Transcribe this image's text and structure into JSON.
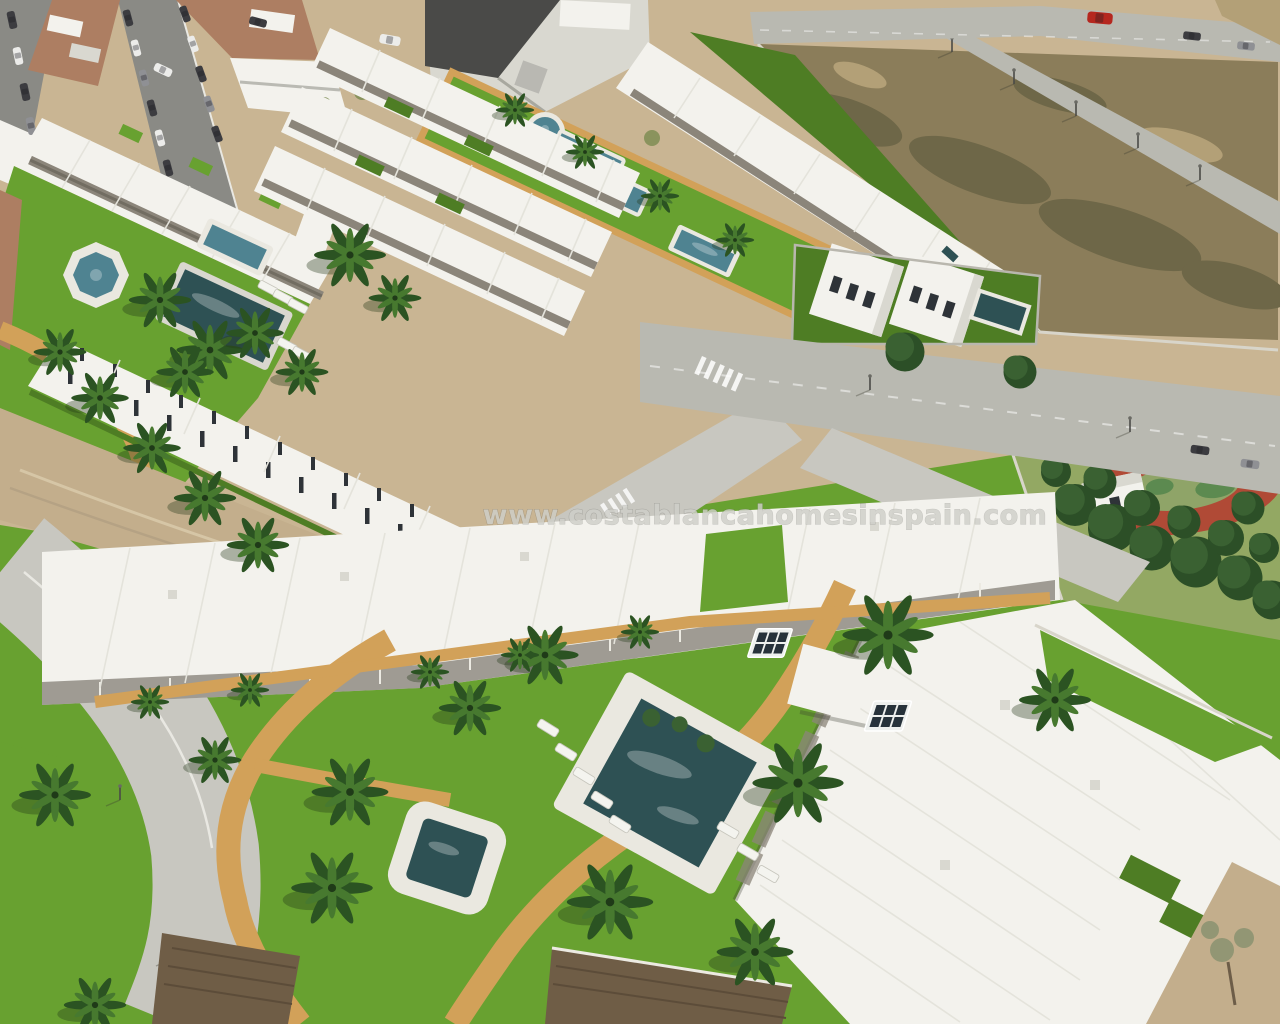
{
  "watermark": {
    "text": "www.costablancahomesinspain.com"
  },
  "colors": {
    "sand": "#c9b593",
    "dirt": "#c3ae8c",
    "field": "#8b7d5a",
    "field_dark": "#6e6748",
    "field_light": "#b3a077",
    "road": "#b9b9b1",
    "road_light": "#c8c7c0",
    "asphalt": "#8a8a85",
    "grass": "#68a130",
    "grass_dark": "#4e7d24",
    "park_grass": "#93a863",
    "tree": "#3a6132",
    "tree_dark": "#2c4f27",
    "tree_olive": "#7a8b50",
    "palm": "#2b5322",
    "palm_light": "#47792f",
    "building": "#f3f2ed",
    "building_shade": "#d9d8d0",
    "building_dark": "#bdbcb4",
    "pergola": "#8b857a",
    "pergola_dark": "#5d574c",
    "wood": "#6f5d46",
    "pool_deep": "#2e5154",
    "pool_mid": "#4f8391",
    "pool_light": "#9ccad6",
    "deck": "#eae8e0",
    "path": "#d2a159",
    "track_red": "#b04a36",
    "track_green": "#5c8a50",
    "terracotta": "#ad7e62",
    "car_red": "#b5271f",
    "watermark_fill": "#cfcfc9"
  }
}
